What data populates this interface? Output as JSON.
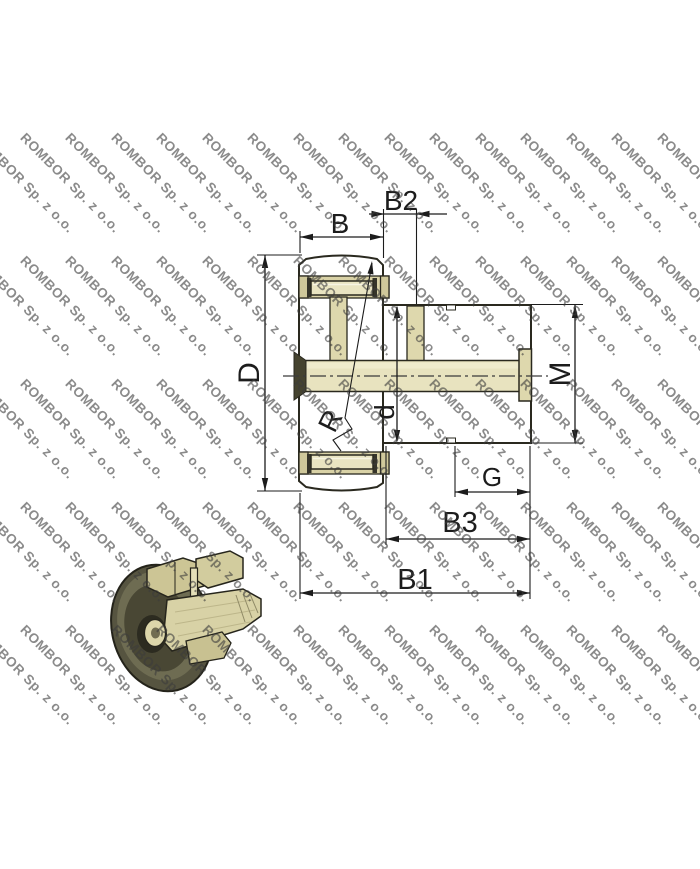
{
  "watermark": {
    "text": "ROMBOR Sp. z o.o.",
    "color": "rgba(60,60,60,0.6)",
    "angle_deg": 45,
    "rows": 5,
    "cols": 16,
    "x_start": -18,
    "y_start": 130,
    "x_step": 45.5,
    "y_step": 123
  },
  "colors": {
    "body": "#d5cfa0",
    "hatch": "#7d7858",
    "outline": "#2a291f",
    "light": "#e8e3bf",
    "inner": "#ded8ad",
    "cavity": "#d9d2a6",
    "rim": "#cfc89b",
    "bore_dark": "#45432f",
    "dim_line": "#1c1c1c",
    "ring_dark": "#565440"
  },
  "dimensions": {
    "B": "B",
    "B2": "B2",
    "D": "D",
    "M": "M",
    "d": "d",
    "R": "R",
    "G": "G",
    "B3": "B3",
    "B1": "B1"
  }
}
